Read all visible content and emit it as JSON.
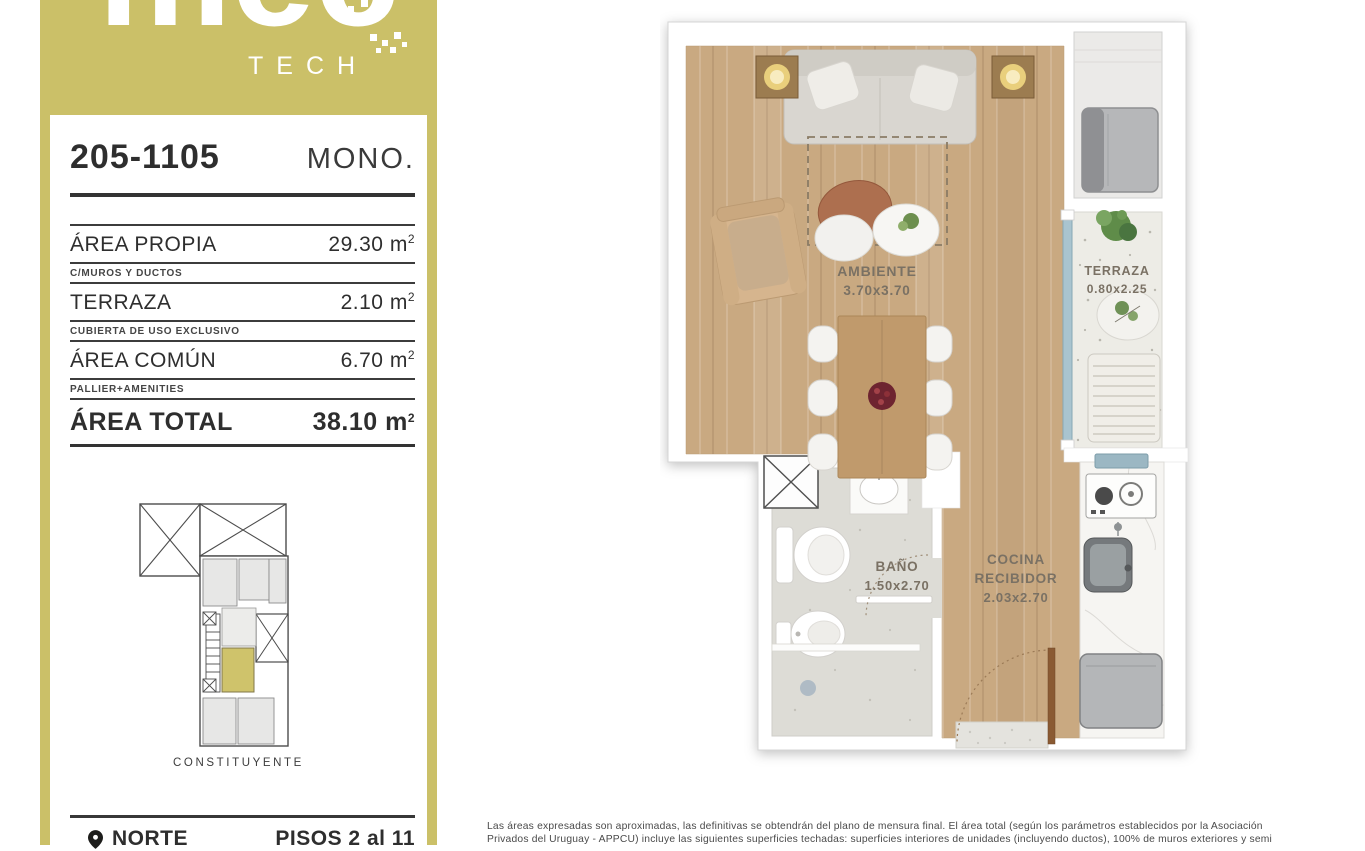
{
  "brand": {
    "name": "mec",
    "sub": "TECH"
  },
  "unit": {
    "code": "205-1105",
    "type_label": "MONO."
  },
  "area_table": {
    "rows": [
      {
        "label": "ÁREA PROPIA",
        "value": "29.30",
        "unit_base": "m",
        "unit_sup": "2",
        "note": "C/MUROS Y DUCTOS"
      },
      {
        "label": "TERRAZA",
        "value": "2.10",
        "unit_base": "m",
        "unit_sup": "2",
        "note": "CUBIERTA DE USO EXCLUSIVO"
      },
      {
        "label": "ÁREA COMÚN",
        "value": "6.70",
        "unit_base": "m",
        "unit_sup": "2",
        "note": "PALLIER+AMENITIES"
      }
    ],
    "total": {
      "label": "ÁREA TOTAL",
      "value": "38.10",
      "unit_base": "m",
      "unit_sup": "2"
    }
  },
  "key_plan": {
    "street": "CONSTITUYENTE"
  },
  "footer": {
    "north": "NORTE",
    "floors": "PISOS 2 al 11"
  },
  "floor_plan": {
    "ambiente": {
      "name": "AMBIENTE",
      "dims": "3.70x3.70"
    },
    "terraza": {
      "name": "TERRAZA",
      "dims": "0.80x2.25"
    },
    "bano": {
      "name": "BAÑO",
      "dims": "1.50x2.70"
    },
    "cocina": {
      "line1": "COCINA",
      "line2": "RECIBIDOR",
      "dims": "2.03x2.70"
    }
  },
  "disclaimer": {
    "line1": "Las áreas expresadas son aproximadas, las definitivas se obtendrán del plano de mensura final. El área total (según los parámetros establecidos por la Asociación",
    "line2": "Privados del Uruguay - APPCU) incluye las siguientes superficies techadas: superficies interiores de unidades (incluyendo ductos), 100% de muros exteriores y semi"
  },
  "colors": {
    "brand_khaki": "#cbc068",
    "wood": "#c9a981",
    "glass": "#a9c4cf",
    "highlight_unit": "#cfc36b"
  }
}
